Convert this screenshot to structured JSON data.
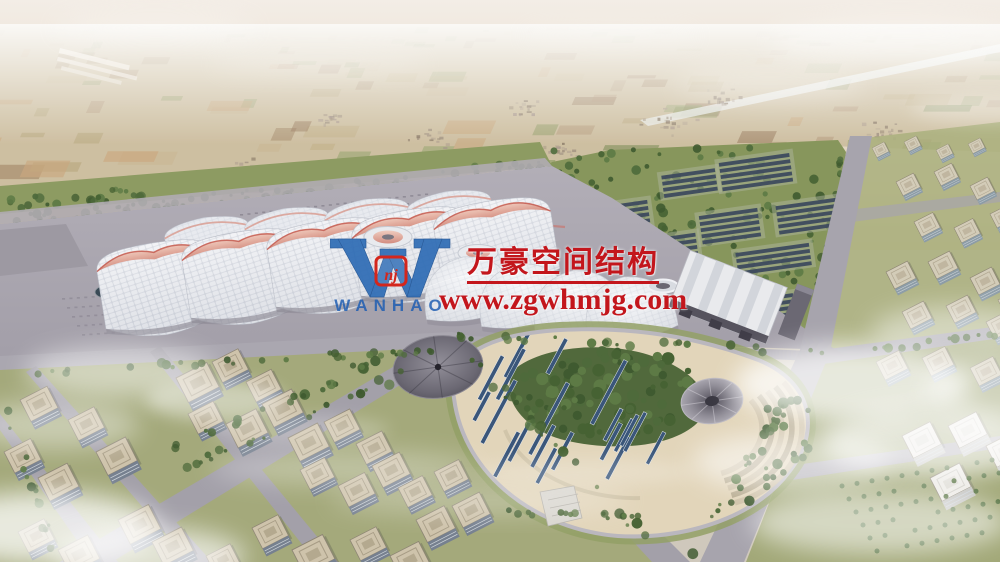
{
  "image": {
    "type": "aerial architectural rendering",
    "description": "Bird's-eye rendering of a large exhibition-center campus: wave-ridged white exhibition halls, a pleated-roof station hall, photovoltaic solar farm among trees, an oval landscaped park with PV strips, a silver canopy dome and a cone pavilion, surrounded by office-block districts, distant patchwork farmland under hazy sky, wispy clouds"
  },
  "watermark": {
    "logo_letter": "W",
    "logo_monogram": "nj",
    "logo_text": "WANHAO",
    "company_name": "万豪空间结构",
    "website": "www.zgwhmjg.com",
    "text_color": "#c3161c",
    "logo_color": "#2e6cb5"
  },
  "palette": {
    "sky_haze": "#f2ece4",
    "farmland_base": "#cbbc9d",
    "field_colors": [
      "#b9a87f",
      "#c2b189",
      "#9aa674",
      "#8f9c66",
      "#a58a6b",
      "#97785c",
      "#b49a7e",
      "#c9b795",
      "#7e8d5a",
      "#caa77e"
    ],
    "tree_colors": [
      "#4e6a3b",
      "#3f5a30",
      "#5d7a45",
      "#466233"
    ],
    "road_grey": "#a4a1aa",
    "esplanade_grey": "#aba7b1",
    "hall_roof_white": "#eef0f4",
    "hall_ridge_pink": "#d88a7c",
    "solar_panel_blue": "#3d4a5e",
    "park_sand": "#e2d5ba",
    "building_roof_beige": "#cec3ab",
    "building_facade_blue": "#76808f",
    "cloud_white": "#ffffff"
  },
  "scene": {
    "view": "aerial oblique",
    "regions": [
      "hazy horizon and distant plains",
      "patchwork farmland with villages and canal",
      "tree belt with photovoltaic arrays",
      "exhibition halls with pink wave ridges",
      "round hub pavilions",
      "pleated-roof station hall",
      "oval park with PV strips, canopy dome, cone pavilion and terraces",
      "office building blocks",
      "clouds"
    ]
  }
}
